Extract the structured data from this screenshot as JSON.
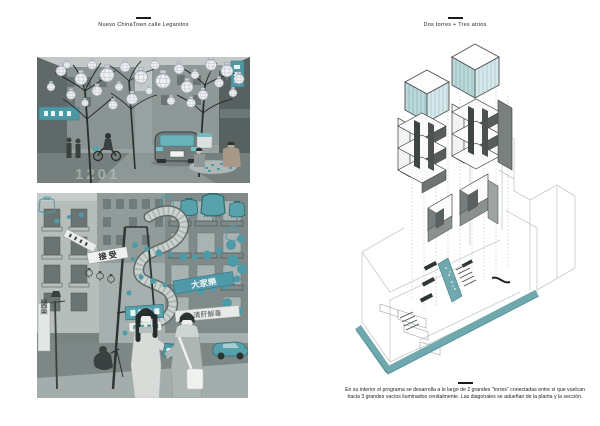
{
  "colors": {
    "teal": "#58a2ac",
    "teal_dark": "#2e6b74",
    "teal_band": "#6fa8ad",
    "photo_gray": "#98a3a1",
    "ink": "#1c1c1c"
  },
  "left_panel": {
    "title": "Nuevo ChinaTown calle Leganitos",
    "photo_top": {
      "description": "street canopy of wireframe lanterns over car and mahjong players",
      "ghost_text": "1201"
    },
    "photo_bottom": {
      "description": "calle Leganitos collage with serpent sculpture and teal lanterns",
      "banner_horizontal": "接 受",
      "banner_teal": "大家樂",
      "banner_white": "清肝解毒",
      "sign_vertical": "醫藥"
    }
  },
  "right_panel": {
    "title": "Dos torres + Tres atrios",
    "caption": {
      "line1": "En su interior el programa se desarrolla a lo largo de 2 grandes \"torres\" conectadas entre sí  que vuelcan",
      "line2": "hacia 3 grandes vacíos iluminados cenitalmente. Las diagonales se adueñan de la planta y la sección."
    }
  }
}
